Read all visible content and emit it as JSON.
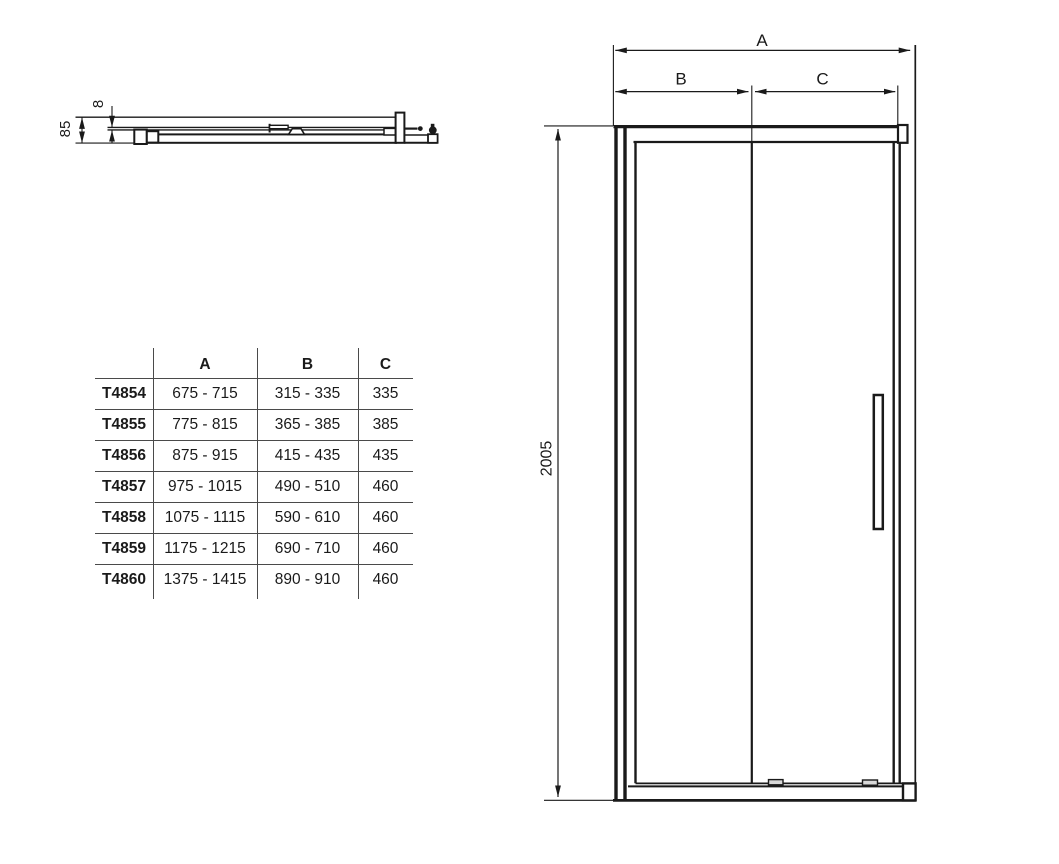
{
  "page": {
    "background": "#ffffff",
    "line_color": "#1a1a1a"
  },
  "profile_view": {
    "glass_thickness_label": "8",
    "depth_label": "85"
  },
  "front_view": {
    "width_label": "A",
    "left_section_label": "B",
    "right_section_label": "C",
    "height_label": "2005"
  },
  "table": {
    "headers": [
      "",
      "A",
      "B",
      "C"
    ],
    "rows": [
      {
        "model": "T4854",
        "a": "675 - 715",
        "b": "315 - 335",
        "c": "335"
      },
      {
        "model": "T4855",
        "a": "775 - 815",
        "b": "365 - 385",
        "c": "385"
      },
      {
        "model": "T4856",
        "a": "875 - 915",
        "b": "415 - 435",
        "c": "435"
      },
      {
        "model": "T4857",
        "a": "975 - 1015",
        "b": "490 - 510",
        "c": "460"
      },
      {
        "model": "T4858",
        "a": "1075 - 1115",
        "b": "590 - 610",
        "c": "460"
      },
      {
        "model": "T4859",
        "a": "1175 - 1215",
        "b": "690 - 710",
        "c": "460"
      },
      {
        "model": "T4860",
        "a": "1375 - 1415",
        "b": "890 - 910",
        "c": "460"
      }
    ]
  }
}
